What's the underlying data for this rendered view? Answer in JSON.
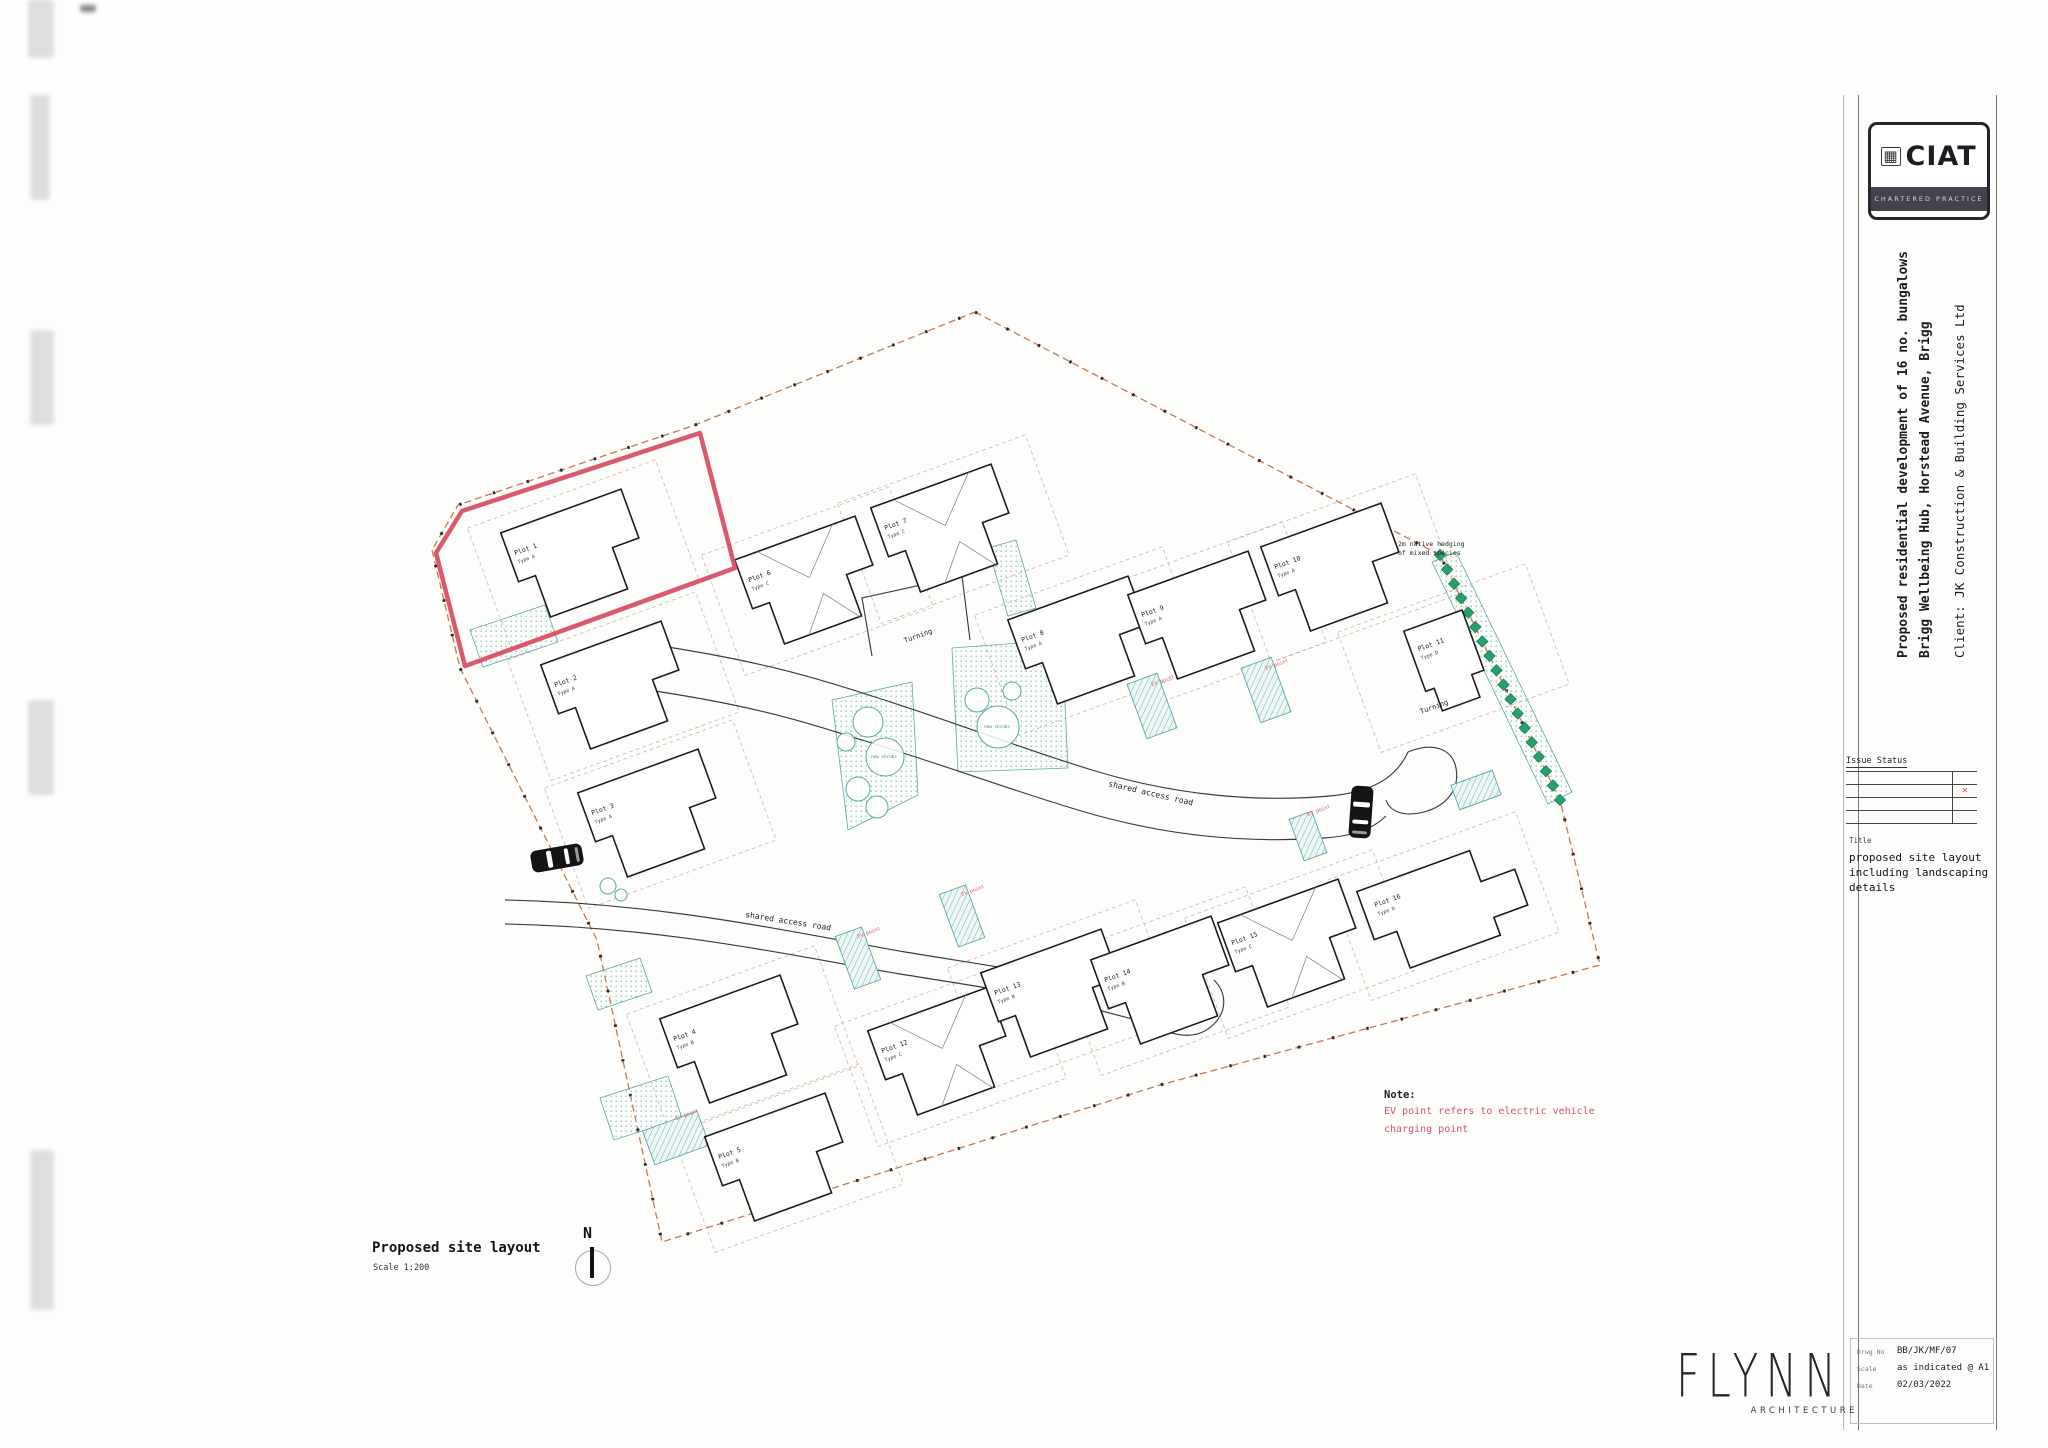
{
  "sheet": {
    "ciat_logo": {
      "text": "CIAT",
      "subtext": "CHARTERED PRACTICE"
    },
    "project": {
      "line1": "Proposed residential development of 16 no. bungalows",
      "line2": "Brigg Wellbeing Hub, Horstead Avenue, Brigg",
      "client": "Client:   JK Construction & Building Services Ltd"
    },
    "issue_status_label": "Issue Status",
    "title_label": "Title",
    "title_lines": [
      "proposed site layout",
      "including landscaping",
      "details"
    ],
    "drawing_info": {
      "no_label": "Drwg No",
      "no": "BB/JK/MF/07",
      "scale_label": "Scale",
      "scale": "as indicated @ A1",
      "date_label": "Date",
      "date": "02/03/2022"
    },
    "architect": {
      "name": "FLYNN",
      "sub": "ARCHITECTURE"
    }
  },
  "plan": {
    "caption": {
      "title": "Proposed site layout",
      "scale": "Scale  1:200"
    },
    "north_label": "N",
    "note": {
      "label": "Note:",
      "lines": [
        "EV point refers to electric vehicle",
        "charging point"
      ]
    },
    "labels": {
      "road": "shared access road",
      "turning": "Turning",
      "ev": "EV point",
      "shrubs": "new shrubs",
      "hedge": [
        "2m native hedging",
        "of mixed species"
      ]
    },
    "plots": [
      {
        "no": "Plot 1",
        "type": "Type A",
        "x": 578,
        "y": 558,
        "kind": "std"
      },
      {
        "no": "Plot 2",
        "type": "Type A",
        "x": 618,
        "y": 690,
        "kind": "std"
      },
      {
        "no": "Plot 3",
        "type": "Type A",
        "x": 655,
        "y": 818,
        "kind": "std"
      },
      {
        "no": "Plot 4",
        "type": "Type B",
        "x": 737,
        "y": 1044,
        "kind": "std"
      },
      {
        "no": "Plot 5",
        "type": "Type B",
        "x": 782,
        "y": 1162,
        "kind": "std"
      },
      {
        "no": "Plot 6",
        "type": "Type C",
        "x": 812,
        "y": 585,
        "kind": "gable"
      },
      {
        "no": "Plot 7",
        "type": "Type C",
        "x": 948,
        "y": 533,
        "kind": "gable"
      },
      {
        "no": "Plot 8",
        "type": "Type A",
        "x": 1085,
        "y": 645,
        "kind": "std"
      },
      {
        "no": "Plot 9",
        "type": "Type A",
        "x": 1205,
        "y": 620,
        "kind": "std"
      },
      {
        "no": "Plot 10",
        "type": "Type A",
        "x": 1338,
        "y": 572,
        "kind": "std"
      },
      {
        "no": "Plot 11",
        "type": "Type D",
        "x": 1448,
        "y": 662,
        "kind": "portrait"
      },
      {
        "no": "Plot 12",
        "type": "Type C",
        "x": 945,
        "y": 1056,
        "kind": "gable"
      },
      {
        "no": "Plot 13",
        "type": "Type B",
        "x": 1058,
        "y": 998,
        "kind": "std"
      },
      {
        "no": "Plot 14",
        "type": "Type B",
        "x": 1168,
        "y": 985,
        "kind": "std"
      },
      {
        "no": "Plot 15",
        "type": "Type C",
        "x": 1295,
        "y": 948,
        "kind": "gable"
      },
      {
        "no": "Plot 16",
        "type": "Type D",
        "x": 1438,
        "y": 910,
        "kind": "lwing"
      }
    ],
    "geometry": {
      "boundary": "975,312 1440,555 1560,800 1600,965 1160,1085 662,1242 597,940 460,668 432,550 458,505 695,425",
      "red_plot": "700,433 462,511 436,553 465,666 735,568",
      "road_edges": [
        "M505,900 C660,903 780,930 905,952 C1010,969 1090,980 1168,1002",
        "M505,924 C660,927 778,953 900,974 C1000,990 1060,998 1150,1024",
        "M648,644 C770,662 828,682 872,696 C960,724 1020,748 1092,770 C1180,797 1262,802 1330,796 C1372,792 1396,778 1408,752",
        "M648,690 C770,708 822,728 862,740 C950,767 1008,789 1078,810 C1170,838 1252,843 1324,838 C1352,836 1372,830 1386,816",
        "M872,656 L862,598 L962,576 L970,640",
        "M1408,752 C1432,742 1452,748 1456,768 C1460,790 1446,806 1424,812 C1404,817 1390,812 1386,800",
        "M1150,1024 C1180,1040 1200,1038 1214,1024 C1228,1010 1226,992 1214,980"
      ],
      "stipples": [
        "832,700 912,682 918,795 848,830",
        "952,648 1062,640 1068,768 958,772",
        "1432,562 1456,552 1572,792 1548,804",
        "470,630 545,605 558,642 483,667",
        "600,1098 668,1076 682,1118 614,1140",
        "586,976 640,958 652,992 598,1010",
        "988,548 1016,540 1036,608 1008,616"
      ],
      "hatches": [
        {
          "x": 1152,
          "y": 706,
          "w": 32,
          "h": 58
        },
        {
          "x": 1266,
          "y": 690,
          "w": 32,
          "h": 58
        },
        {
          "x": 1308,
          "y": 836,
          "w": 24,
          "h": 44
        },
        {
          "x": 1476,
          "y": 790,
          "w": 44,
          "h": 26
        },
        {
          "x": 858,
          "y": 958,
          "w": 28,
          "h": 56
        },
        {
          "x": 962,
          "y": 916,
          "w": 28,
          "h": 56
        },
        {
          "x": 676,
          "y": 1138,
          "w": 58,
          "h": 36
        }
      ],
      "trees": [
        [
          868,
          722,
          15
        ],
        [
          885,
          757,
          19
        ],
        [
          858,
          789,
          12
        ],
        [
          846,
          742,
          9
        ],
        [
          877,
          807,
          11
        ],
        [
          998,
          727,
          21
        ],
        [
          977,
          700,
          12
        ],
        [
          1012,
          691,
          9
        ],
        [
          608,
          886,
          8
        ],
        [
          621,
          895,
          6
        ]
      ],
      "shrub_label_pos": [
        [
          884,
          758
        ],
        [
          997,
          728
        ]
      ],
      "hedge_line": [
        1440,
        555,
        1560,
        800
      ],
      "hedge_note_pos": [
        1398,
        546
      ],
      "road_label_pos": [
        [
          745,
          917,
          9
        ],
        [
          1108,
          786,
          13
        ]
      ],
      "turning_label_pos": [
        [
          905,
          643,
          -20
        ],
        [
          1421,
          714,
          -20
        ]
      ],
      "ev_label_pos": [
        [
          858,
          938
        ],
        [
          962,
          896
        ],
        [
          1152,
          686
        ],
        [
          1266,
          670
        ],
        [
          1308,
          816
        ],
        [
          676,
          1120
        ]
      ],
      "cars": [
        {
          "x": 557,
          "y": 858,
          "rot": -10,
          "vert": false
        },
        {
          "x": 1361,
          "y": 812,
          "rot": 4,
          "vert": true
        }
      ]
    }
  },
  "colors": {
    "boundary": "#c87848",
    "highlight": "#d84b60",
    "hedge_green": "#28a06b",
    "teal": "#57aaa2",
    "note_red": "#d6506e",
    "building_line": "#1c1c1c",
    "parcel_dash": "#c9a9a9"
  }
}
